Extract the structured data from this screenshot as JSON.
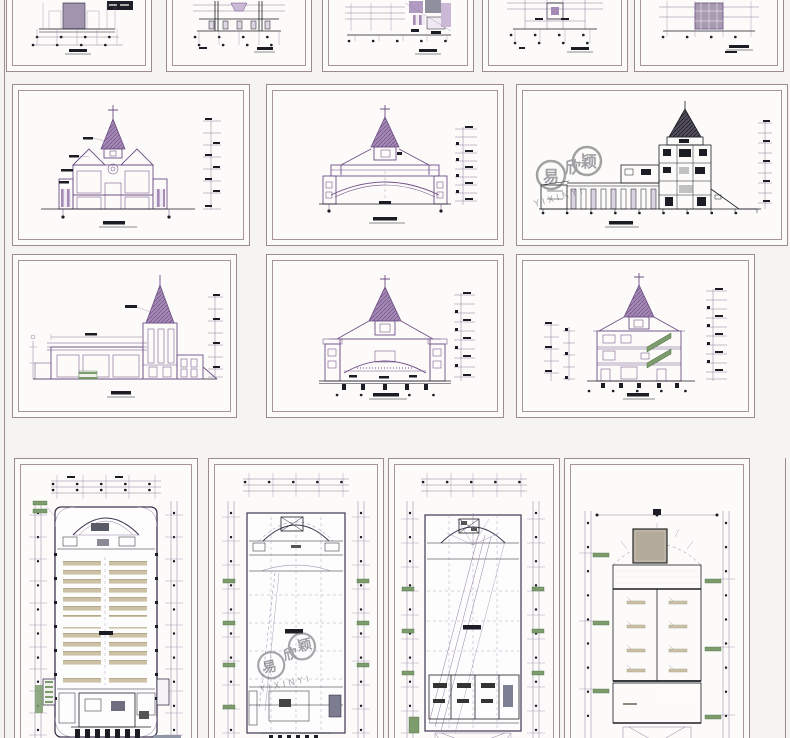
{
  "page": {
    "title": "church CAD drawing set preview",
    "sheet_count": 15
  },
  "palette": {
    "background": "#f6f4f3",
    "sheet": "#fcfbfa",
    "sheet_border": "#9e8c8c",
    "elevation_purple": "#a48ab5",
    "elevation_dark_purple": "#6f4f86",
    "section_ink": "#1c1c24",
    "dimension_line": "#8d7d9d",
    "accent_green": "#7d9c6d",
    "pew_tan": "#cec2a6",
    "roof_gray": "#c6bfb2"
  },
  "watermark": {
    "chars": [
      "易",
      "欣",
      "颖"
    ],
    "latin": "YIXINYI"
  },
  "sheets": [
    {
      "name": "plan-fragment-1"
    },
    {
      "name": "plan-fragment-2"
    },
    {
      "name": "plan-fragment-3"
    },
    {
      "name": "plan-fragment-4"
    },
    {
      "name": "plan-fragment-5"
    },
    {
      "name": "front-elevation"
    },
    {
      "name": "entrance-arch-elevation"
    },
    {
      "name": "longitudinal-section"
    },
    {
      "name": "side-elevation"
    },
    {
      "name": "cross-section-arch"
    },
    {
      "name": "stair-section"
    },
    {
      "name": "ground-floor-plan"
    },
    {
      "name": "gallery-floor-plan"
    },
    {
      "name": "upper-floor-plan"
    },
    {
      "name": "roof-plan"
    }
  ]
}
